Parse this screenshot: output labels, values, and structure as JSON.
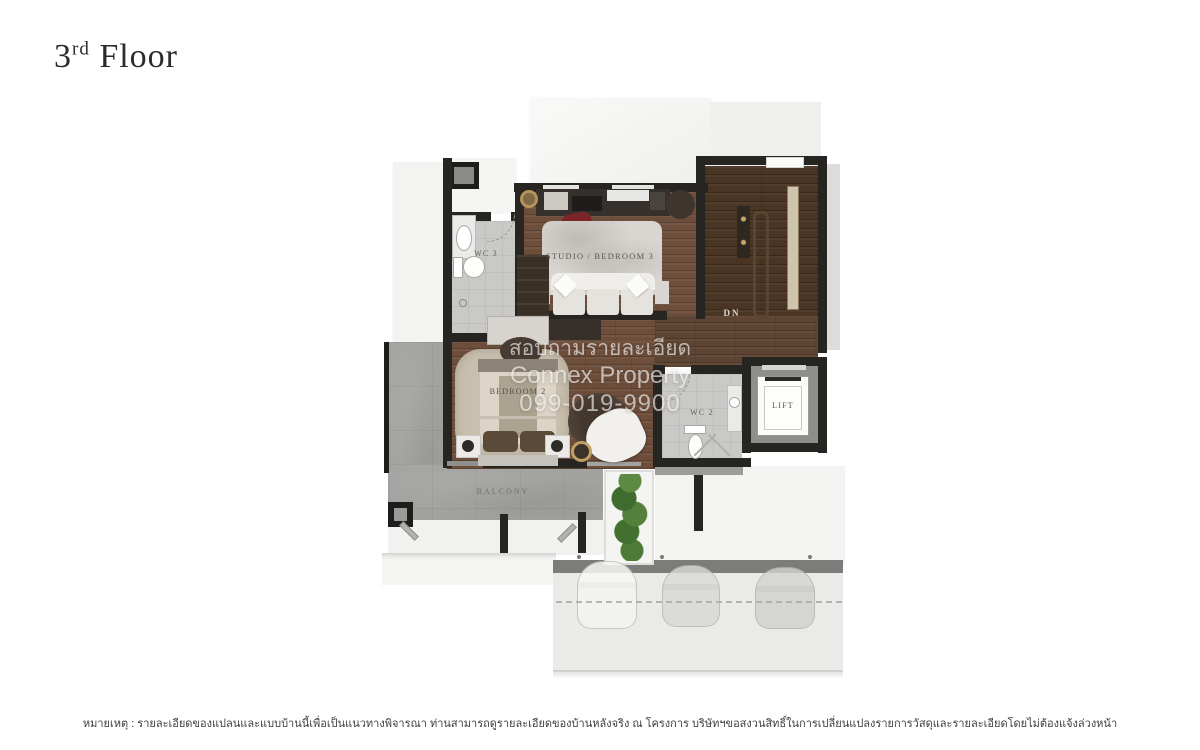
{
  "title": {
    "number": "3",
    "ordinal": "rd",
    "word": "Floor"
  },
  "watermark": {
    "line1": "สอบถามรายละเอียด",
    "line2": "Connex Property",
    "line3": "099-019-9900"
  },
  "labels": {
    "wc3": "WC 3",
    "studio_bedroom3": "STUDIO / BEDROOM 3",
    "stairs_down": "DN",
    "bedroom2": "BEDROOM 2",
    "wc2": "WC 2",
    "lift": "LIFT",
    "balcony": "BALCONY"
  },
  "footer": {
    "note": "หมายเหตุ : รายละเอียดของแปลนและแบบบ้านนี้เพื่อเป็นแนวทางพิจารณา ท่านสามารถดูรายละเอียดของบ้านหลังจริง ณ โครงการ บริษัทฯขอสงวนสิทธิ์ในการเปลี่ยนแปลงรายการวัสดุและรายละเอียดโดยไม่ต้องแจ้งล่วงหน้า"
  },
  "colors": {
    "wood_floor": "#6d4e3b",
    "stair_wood": "#4a3525",
    "balcony_concrete": "#a2a2a0",
    "wall": "#272522",
    "accent_chair_red": "#7b2527",
    "plant_green": "#4e7a38",
    "watermark_text": "#ffffff"
  }
}
